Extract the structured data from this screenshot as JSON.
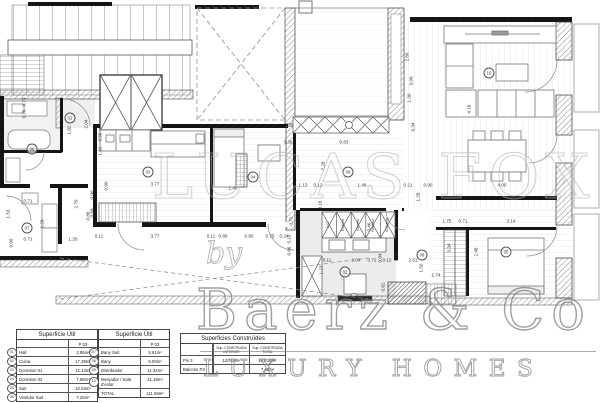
{
  "watermark": {
    "backdrop": "LUCAS FOX",
    "by": "by",
    "brand": "Baerz & Co",
    "tagline": "LUXURY HOMES"
  },
  "tables": [
    {
      "title": "Superficie Útil",
      "subcol": "P 03",
      "rows": [
        {
          "ref": "01",
          "label": "Hall",
          "value": "2.85m²"
        },
        {
          "ref": "02",
          "label": "Cuina",
          "value": "17.39m²"
        },
        {
          "ref": "03",
          "label": "Dormitori 01",
          "value": "12.13m²"
        },
        {
          "ref": "04",
          "label": "Dormitori 02",
          "value": "7.88m²"
        },
        {
          "ref": "05",
          "label": "Suit",
          "value": "10.63m²"
        },
        {
          "ref": "06",
          "label": "Vestidor Suit",
          "value": "7.25m²"
        }
      ]
    },
    {
      "title": "Superficie Útil",
      "subcol": "P 03",
      "rows": [
        {
          "ref": "07",
          "label": "Bany Suit",
          "value": "5.61m²"
        },
        {
          "ref": "08",
          "label": "Bany",
          "value": "5.00m²"
        },
        {
          "ref": "09",
          "label": "Distribuidor",
          "value": "11.34m²"
        },
        {
          "ref": "10",
          "label": "Menjador / Sala d'estar",
          "value": "31.48m²"
        },
        {
          "ref": "",
          "label": "TOTAL",
          "value": "111.58m²"
        }
      ]
    },
    {
      "title": "Superficies Construïdes",
      "cols": [
        "Sup. CONSTRUIDA INTERIOR",
        "Sup. CONSTRUIDA TOTAL"
      ],
      "rows": [
        {
          "label": "Pis 3",
          "v1": "120.16m²",
          "v2": "131.10m²"
        },
        {
          "label": "Balcons P3",
          "v1": "",
          "v2": "7.40m²"
        }
      ]
    }
  ],
  "plan": {
    "closet_labels": [
      [
        "A/C",
        329,
        225
      ],
      [
        "Rebost",
        344,
        225
      ],
      [
        "Nevera",
        359,
        225
      ],
      [
        "Rentad.",
        374,
        225
      ],
      [
        "Safareig",
        388,
        225
      ]
    ],
    "refs": [
      [
        "01",
        70,
        118
      ],
      [
        "02",
        345,
        272
      ],
      [
        "03",
        148,
        172
      ],
      [
        "04",
        253,
        177
      ],
      [
        "05",
        506,
        252
      ],
      [
        "06",
        32,
        149
      ],
      [
        "07",
        27,
        228
      ],
      [
        "08",
        422,
        255
      ],
      [
        "09",
        348,
        172
      ],
      [
        "10",
        489,
        73
      ]
    ],
    "dims": [
      [
        "3.38",
        288,
        143,
        0
      ],
      [
        "0.83",
        344,
        143,
        0
      ],
      [
        "7.28",
        324,
        166,
        1
      ],
      [
        "1.13",
        303,
        186,
        0
      ],
      [
        "0.12",
        318,
        186,
        0
      ],
      [
        "1.49",
        362,
        186,
        0
      ],
      [
        "0.21",
        408,
        186,
        0
      ],
      [
        "0.90",
        428,
        186,
        0
      ],
      [
        "4.00",
        502,
        186,
        0
      ],
      [
        "3.77",
        155,
        185,
        0
      ],
      [
        "1.45",
        233,
        189,
        0
      ],
      [
        "0.90",
        107,
        186,
        1
      ],
      [
        "1.62",
        101,
        151,
        1
      ],
      [
        "0.56",
        101,
        137,
        1
      ],
      [
        "0.11",
        99,
        237,
        0
      ],
      [
        "3.77",
        155,
        237,
        0
      ],
      [
        "0.11",
        211,
        237,
        0
      ],
      [
        "0.80",
        223,
        237,
        0
      ],
      [
        "0.90",
        249,
        237,
        0
      ],
      [
        "0.75",
        270,
        237,
        0
      ],
      [
        "0.24",
        284,
        237,
        0
      ],
      [
        "0.89",
        93,
        213,
        1
      ],
      [
        "0.90",
        93,
        195,
        1
      ],
      [
        "0.11",
        327,
        261,
        0
      ],
      [
        "2.04",
        356,
        261,
        0
      ],
      [
        "0.72",
        372,
        261,
        0
      ],
      [
        "0.12",
        387,
        261,
        0
      ],
      [
        "2.61",
        413,
        261,
        0
      ],
      [
        "1.74",
        436,
        276,
        0
      ],
      [
        "1.23",
        322,
        270,
        1
      ],
      [
        "1.50",
        397,
        257,
        1
      ],
      [
        "1.50",
        422,
        268,
        1
      ],
      [
        "0.94",
        381,
        258,
        1
      ],
      [
        "0.62",
        384,
        287,
        1
      ],
      [
        "1.75",
        447,
        222,
        0
      ],
      [
        "0.71",
        463,
        222,
        0
      ],
      [
        "3.14",
        511,
        222,
        0
      ],
      [
        "2.48",
        477,
        252,
        1
      ],
      [
        "3.34",
        450,
        248,
        1
      ],
      [
        "2.66",
        408,
        57,
        1
      ],
      [
        "3.99",
        412,
        81,
        1
      ],
      [
        "1.30",
        410,
        98,
        1
      ],
      [
        "0.34",
        414,
        127,
        1
      ],
      [
        "4.16",
        470,
        109,
        1
      ],
      [
        "0.16",
        321,
        205,
        1
      ],
      [
        "0.72",
        292,
        221,
        1
      ],
      [
        "5.10",
        290,
        239,
        1
      ],
      [
        "0.66",
        290,
        251,
        1
      ],
      [
        "1.28",
        419,
        197,
        1
      ],
      [
        "0.46",
        370,
        227,
        1
      ],
      [
        "0.73",
        25,
        102,
        1
      ],
      [
        "0.75",
        25,
        114,
        1
      ],
      [
        "1.82",
        70,
        130,
        1
      ],
      [
        "2.04",
        87,
        124,
        1
      ],
      [
        "1.53",
        9,
        214,
        1
      ],
      [
        "2.28",
        43,
        224,
        1
      ],
      [
        "0.71",
        28,
        202,
        0
      ],
      [
        "0.71",
        28,
        240,
        0
      ],
      [
        "1.20",
        73,
        240,
        0
      ],
      [
        "0.90",
        12,
        243,
        1
      ],
      [
        "2.70",
        77,
        204,
        1
      ],
      [
        "0.88",
        89,
        216,
        1
      ]
    ]
  }
}
